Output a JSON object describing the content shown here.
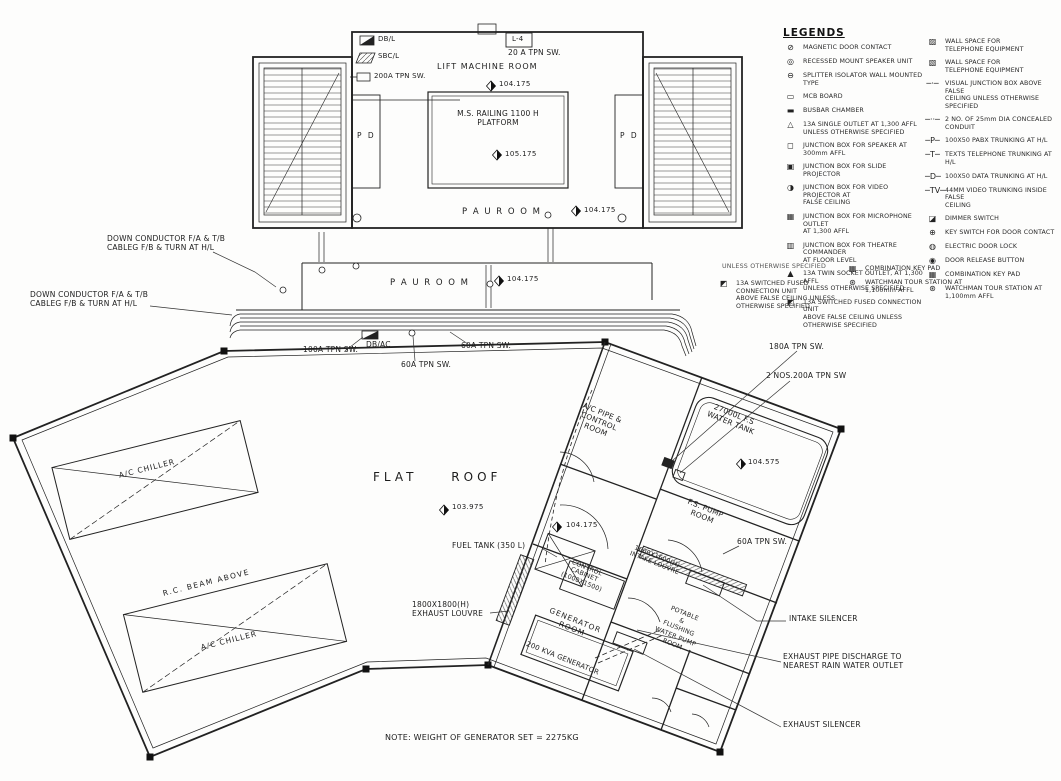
{
  "plan": {
    "mini_legend": {
      "db": {
        "glyph": "◪",
        "label": "DB/L"
      },
      "sbc": {
        "glyph": "▨",
        "label": "SBC/L"
      },
      "sw": {
        "glyph": "▯",
        "label": "200A TPN SW."
      }
    },
    "labels": {
      "l4": "L-4",
      "sw_20a": "20 A TPN SW.",
      "lift_machine_room": "LIFT MACHINE ROOM",
      "lift_level": "104.175",
      "platform": "M.S. RAILING 1100 H\nPLATFORM",
      "platform_level": "105.175",
      "pd_left": "P D",
      "pd_right": "P D",
      "pau_room_upper": "P A U   R O O M",
      "pau_upper_level": "104.175",
      "pau_room_lower": "P A U   R O O M",
      "pau_lower_level": "104.175",
      "down_conductor_1": "DOWN CONDUCTOR F/A & T/B\nCABLEG F/B & TURN AT H/L",
      "down_conductor_2": "DOWN CONDUCTOR F/A & T/B\nCABLEG F/B & TURN AT H/L",
      "sw_100a": "100A TPN SW.",
      "db_ac": "DB/AC",
      "sw_60a_right": "60A TPN SW.",
      "sw_60a_below": "60A TPN SW.",
      "sw_180a": "180A TPN SW.",
      "sw_2nos_200a": "2 NOS.200A TPN SW",
      "ac_pipe_room": "A/C PIPE &\nCONTROL ROOM",
      "water_tank": "27000L F.S\nWATER TANK",
      "water_tank_level": "104.575",
      "fs_pump_room": "F.S. PUMP\nROOM",
      "sw_60a_pump": "60A TPN SW.",
      "flat_roof": "FLAT ROOF",
      "flat_roof_level": "103.975",
      "fuel_tank": "FUEL TANK (350 L)",
      "control_cabinet": "CONTROL\nCABINET\n(1000X1500)",
      "intake_louvre": "1600X1600(H)\nINTAKE LOUVRE",
      "generator_level": "104.175",
      "generator_room": "GENERATOR\nROOM",
      "generator": "200 KVA GENERATOR",
      "exhaust_louvre": "1800X1800(H)\nEXHAUST LOUVRE",
      "potable_room": "POTABLE\n&\nFLUSHING\nWATER PUMP\nROOM",
      "intake_silencer": "INTAKE SILENCER",
      "exhaust_pipe": "EXHAUST PIPE DISCHARGE TO\nNEAREST RAIN WATER OUTLET",
      "exhaust_silencer": "EXHAUST SILENCER",
      "chiller_1": "A/C CHILLER",
      "chiller_2": "A/C CHILLER",
      "rc_beam": "R.C. BEAM ABOVE",
      "note": "NOTE: WEIGHT OF GENERATOR SET = 2275KG"
    }
  },
  "legends": {
    "title": "LEGENDS",
    "col1": [
      {
        "symbol": "magnetic-door-contact",
        "glyph": "⊘",
        "label": "MAGNETIC DOOR CONTACT"
      },
      {
        "symbol": "recessed-speaker",
        "glyph": "◎",
        "label": "RECESSED MOUNT SPEAKER UNIT"
      },
      {
        "symbol": "splitter-isolator",
        "glyph": "⊖",
        "label": "SPLITTER ISOLATOR WALL MOUNTED TYPE"
      },
      {
        "symbol": "mcb-board",
        "glyph": "▭",
        "label": "MCB BOARD"
      },
      {
        "symbol": "busbar-chamber",
        "glyph": "▬",
        "label": "BUSBAR CHAMBER"
      },
      {
        "symbol": "single-outlet",
        "glyph": "△",
        "label": "13A SINGLE OUTLET AT 1,300 AFFL\nUNLESS OTHERWISE SPECIFIED"
      },
      {
        "symbol": "jb-speaker",
        "glyph": "◻",
        "label": "JUNCTION BOX FOR SPEAKER AT 300mm AFFL"
      },
      {
        "symbol": "jb-slide",
        "glyph": "▣",
        "label": "JUNCTION BOX FOR SLIDE PROJECTOR"
      },
      {
        "symbol": "jb-video",
        "glyph": "◑",
        "label": "JUNCTION BOX FOR VIDEO PROJECTOR AT\nFALSE CEILING"
      },
      {
        "symbol": "jb-microphone",
        "glyph": "▦",
        "label": "JUNCTION BOX FOR MICROPHONE OUTLET\nAT 1,300 AFFL"
      },
      {
        "symbol": "jb-theatre",
        "glyph": "▥",
        "label": "JUNCTION BOX FOR THEATRE COMMANDER\nAT FLOOR LEVEL"
      },
      {
        "symbol": "twin-socket",
        "glyph": "▲",
        "label": "13A TWIN SOCKET OUTLET, AT 1,300 AFFL\nUNLESS OTHERWISE SPECIFIED"
      },
      {
        "symbol": "switched-fused-unit",
        "glyph": "◩",
        "label": "13A SWITCHED FUSED CONNECTION UNIT\nABOVE FALSE CEILING UNLESS\nOTHERWISE SPECIFIED"
      }
    ],
    "col2": [
      {
        "symbol": "wall-space-telephone-1",
        "glyph": "▨",
        "label": "WALL SPACE FOR\nTELEPHONE EQUIPMENT"
      },
      {
        "symbol": "wall-space-telephone-2",
        "glyph": "▧",
        "label": "WALL SPACE FOR\nTELEPHONE EQUIPMENT"
      },
      {
        "symbol": "visual-junction-box",
        "glyph": "─·─",
        "label": "VISUAL JUNCTION BOX ABOVE FALSE\nCEILING UNLESS OTHERWISE SPECIFIED"
      },
      {
        "symbol": "concealed-conduit",
        "glyph": "─··─",
        "label": "2 NO. OF 25mm DIA CONCEALED CONDUIT"
      },
      {
        "symbol": "pabx-trunking",
        "glyph": "─P─",
        "label": "100X50 PABX TRUNKING AT H/L"
      },
      {
        "symbol": "telephone-trunking",
        "glyph": "─T─",
        "label": "TEXTS TELEPHONE TRUNKING AT H/L"
      },
      {
        "symbol": "data-trunking",
        "glyph": "─D─",
        "label": "100X50 DATA TRUNKING AT H/L"
      },
      {
        "symbol": "video-trunking",
        "glyph": "─TV─",
        "label": "44MM VIDEO TRUNKING INSIDE FALSE\nCEILING"
      },
      {
        "symbol": "dimmer-switch",
        "glyph": "◪",
        "label": "DIMMER SWITCH"
      },
      {
        "symbol": "key-switch",
        "glyph": "⊕",
        "label": "KEY SWITCH FOR DOOR CONTACT"
      },
      {
        "symbol": "electric-door-lock",
        "glyph": "◍",
        "label": "ELECTRIC DOOR LOCK"
      },
      {
        "symbol": "door-release-button",
        "glyph": "◉",
        "label": "DOOR RELEASE BUTTON"
      },
      {
        "symbol": "combination-key-pad",
        "glyph": "▦",
        "label": "COMBINATION KEY PAD"
      },
      {
        "symbol": "watchman-tour-station",
        "glyph": "⊛",
        "label": "WATCHMAN TOUR STATION AT\n1,100mm AFFL"
      }
    ],
    "extra": {
      "fragment": "UNLESS OTHERWISE SPECIFIED",
      "switched_fused": {
        "glyph": "◩",
        "label": "13A SWITCHED FUSED CONNECTION UNIT\nABOVE FALSE CEILING UNLESS\nOTHERWISE SPECIFIED"
      },
      "combination_key_pad": {
        "glyph": "▦",
        "label": "COMBINATION KEY PAD"
      },
      "watchman": {
        "glyph": "⊛",
        "label": "WATCHMAN TOUR STATION AT\n1,100mm AFFL"
      }
    }
  }
}
